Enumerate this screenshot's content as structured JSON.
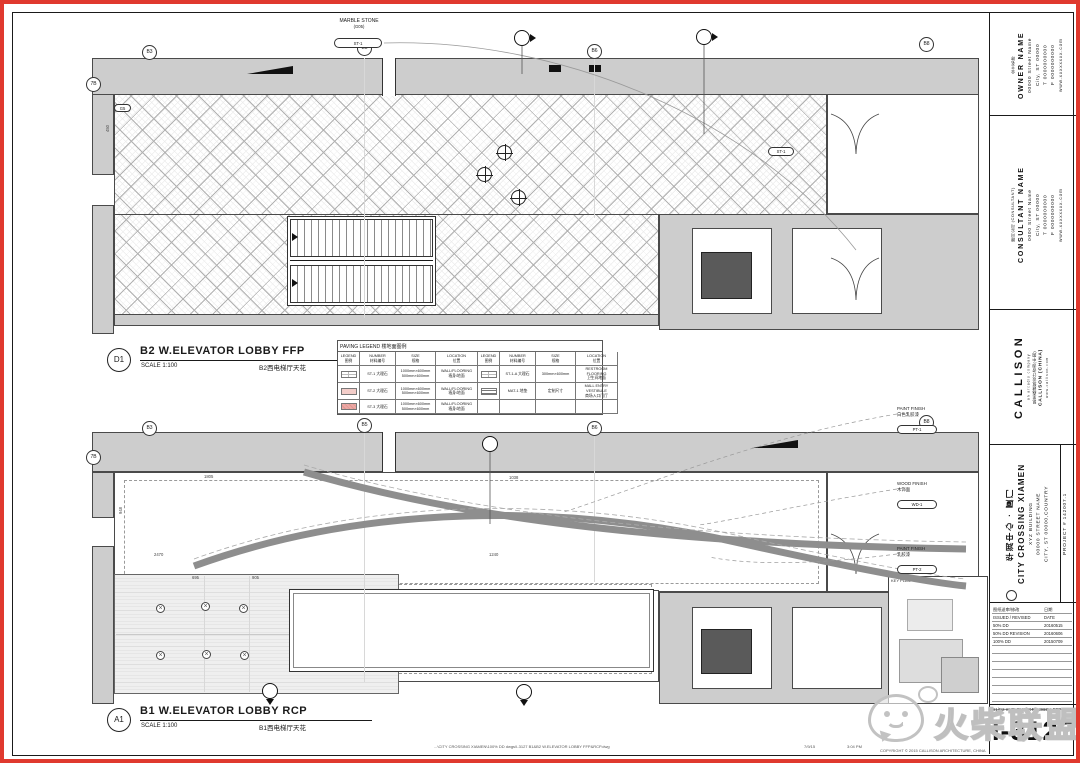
{
  "drawings": {
    "top": {
      "callout": "D1",
      "title": "B2 W.ELEVATOR LOBBY FFP",
      "scale": "SCALE 1:100",
      "subtitle_cn": "B2西电梯厅天花",
      "grid_bubbles_top": [
        "B3",
        "B5",
        "B6",
        "B8"
      ],
      "grid_bubble_left": "7B",
      "note_marble": {
        "line1": "MARBLE STONE",
        "line2": "(G05)",
        "tag": "ST-1"
      },
      "floor_tag": "ST-1",
      "side_tag": "G5",
      "dim_side": "450"
    },
    "bottom": {
      "callout": "A1",
      "title": "B1 W.ELEVATOR LOBBY RCP",
      "scale": "SCALE 1:100",
      "subtitle_cn": "B1西电梯厅天花",
      "grid_bubbles_top": [
        "B3",
        "B5",
        "B6",
        "B8"
      ],
      "grid_bubble_left": "7B",
      "tags": [
        {
          "line1": "PAINT FINISH",
          "line2": "白色乳胶漆",
          "tag": "PT-1"
        },
        {
          "line1": "WOOD FINISH",
          "line2": "木饰面",
          "tag": "WD-1"
        },
        {
          "line1": "PAINT FINISH",
          "line2": "乳胶漆",
          "tag": "PT-2"
        }
      ],
      "dims": {
        "d1": "1805",
        "d2": "1038",
        "d3": "2470",
        "d4": "1240",
        "d5": "695",
        "d6": "905",
        "d7": "948"
      }
    }
  },
  "legend": {
    "title": "PAVING LEGEND 楼地面图例",
    "headers_en": [
      "LEGEND",
      "NUMBER",
      "SIZE",
      "LOCATION"
    ],
    "headers_cn": [
      "图例",
      "材料编号",
      "规格",
      "位置"
    ],
    "rows_left": [
      {
        "number": "ST-1 大理石",
        "size": "1000mm×600mm\n500mm×600mm",
        "location": "WALL/FLOORING\n墙身/地面"
      },
      {
        "number": "ST-2 大理石",
        "size": "1000mm×600mm\n500mm×600mm",
        "location": "WALL/FLOORING\n墙身/地面"
      },
      {
        "number": "ST-3 大理石",
        "size": "1000mm×600mm\n500mm×600mm",
        "location": "WALL/FLOORING\n墙身/地面"
      }
    ],
    "rows_right": [
      {
        "number": "ST-1-A 大理石",
        "size": "300mm×600mm",
        "location": "RESTROOM FLOORING\n卫生间地面"
      },
      {
        "number": "MAT-1 地垫",
        "size": "定制尺寸",
        "location": "MALL ENTRY VESTIBULE\n商场入口门厅"
      }
    ]
  },
  "titleblock": {
    "owner": {
      "label_cn": "业主名称",
      "name": "OWNER NAME",
      "address1": "00000 Street Name",
      "address2": "City, ST 00000",
      "tel": "T 0000000000",
      "fax": "F 0000000000",
      "web": "www.xxxxxxxx.com"
    },
    "consultant": {
      "label_cn": "顾问公司 (CONSULTANT)",
      "name": "CONSULTANT NAME",
      "address1": "0000 Street Name",
      "address2": "City, ST 00000",
      "tel": "T 0000000000",
      "fax": "F 0000000000",
      "web": "www.xxxxxxxx.com"
    },
    "firm": {
      "logo": "CALLISON",
      "tagline": "an arcadis company",
      "name_cn": "凯里森建筑设计咨询(中国)",
      "name": "CALLISON (CHINA)",
      "web": "www.callison.com"
    },
    "project": {
      "name_cn": "华润中心 · 厦门",
      "name": "CITY CROSSING XIAMEN",
      "line1": "XYZ BUILDING",
      "line2": "00000 STREET NAME",
      "line3": "CITY, ST 00000,COUNTRY",
      "number": "PROJECT # 142007.1"
    },
    "revisions": {
      "header_cn": [
        "图纸送审/修改",
        "日期"
      ],
      "header_en": [
        "ISSUED / REVISED",
        "DATE"
      ],
      "rows": [
        [
          "50% DD",
          "20160515"
        ],
        [
          "50% DD REVISION",
          "20160606"
        ],
        [
          "100% DD",
          "20150709"
        ]
      ]
    },
    "keyplan_label": "KEY PLAN",
    "sheet": {
      "title": "B1/B2 W.ELEVATOR LOBBY FFP&RCP",
      "number": "I-3127"
    }
  },
  "footer": {
    "path": "...\\CITY CROSSING XIAMEN\\100% DD dwgs\\I-3127 B1&B2 W.ELEVATOR LOBBY FFP&RCP.dwg",
    "date": "7/9/15",
    "time": "3:04 PM",
    "copyright": "COPYRIGHT © 2015 CALLISON ARCHITECTURE, CHINA"
  },
  "watermark": {
    "text": "火柴联盟"
  }
}
